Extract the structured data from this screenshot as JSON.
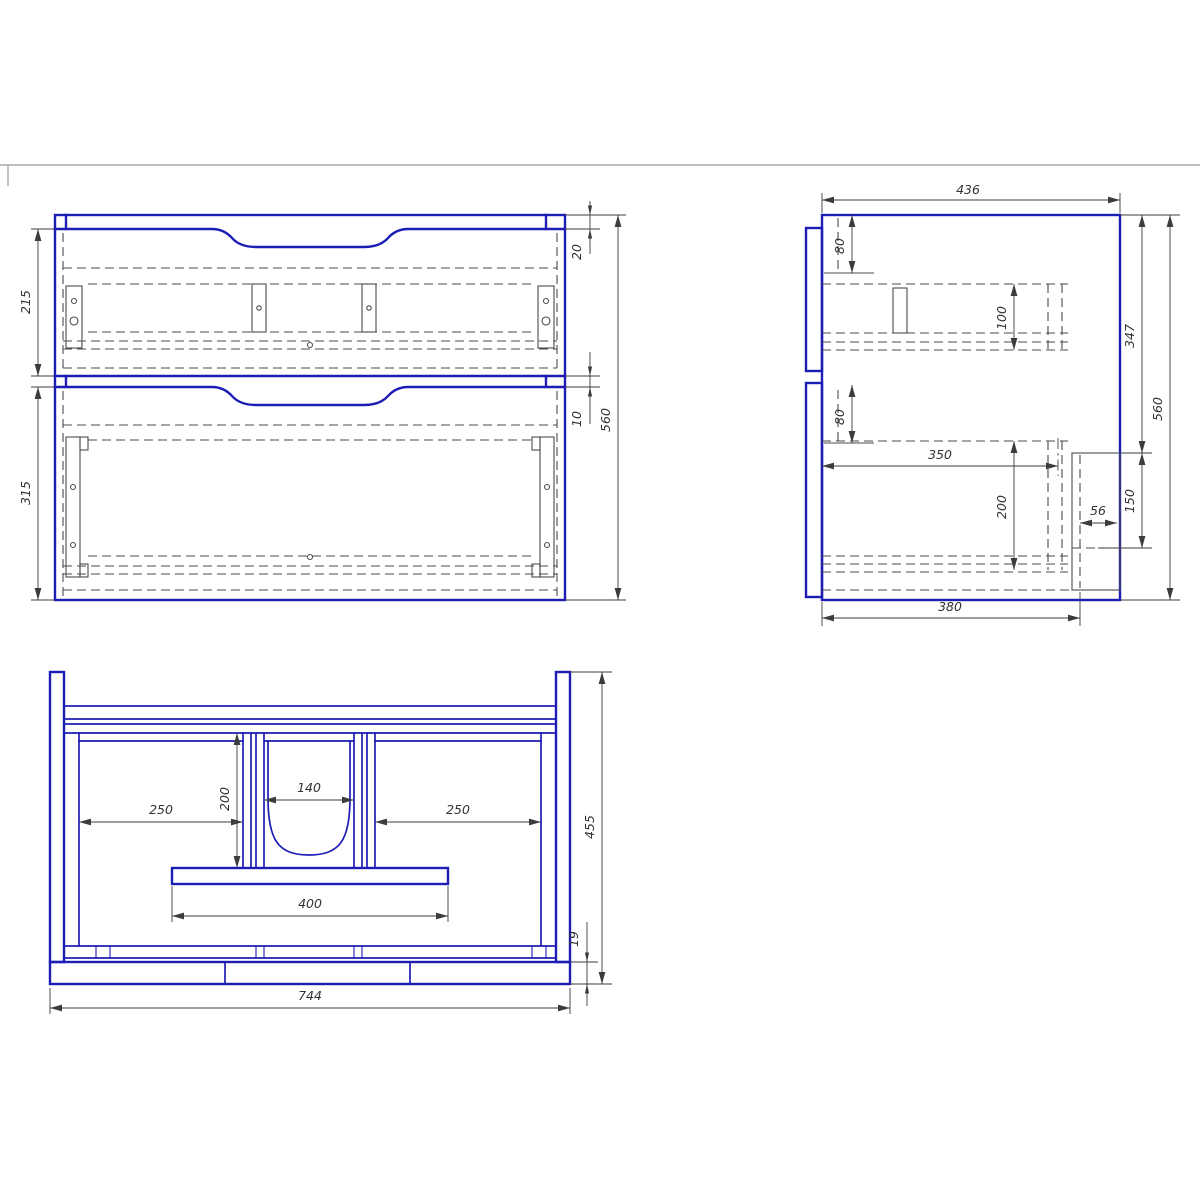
{
  "drawing": {
    "kind": "cabinet-technical-drawing",
    "colors": {
      "line_blue": "#1d1db5",
      "line_gray": "#4b4b4b",
      "frame_gray": "#9b9b9b",
      "text": "#333333"
    },
    "front_view": {
      "dims": {
        "top_panel_height": "20",
        "drawer1_height": "215",
        "gap": "10",
        "drawer2_height": "315",
        "total_height": "560"
      }
    },
    "side_view": {
      "dims": {
        "depth": "436",
        "upper_offset": "80",
        "rail_height": "100",
        "upper_section": "347",
        "total_height": "560",
        "lower_offset": "80",
        "runner_depth": "350",
        "lower_rail_height": "200",
        "bracket_inset": "56",
        "bracket_height": "150",
        "bottom_depth": "380"
      }
    },
    "bottom_view": {
      "dims": {
        "left_bay_width": "250",
        "center_depth": "200",
        "center_opening": "140",
        "right_bay_width": "250",
        "plate_width": "400",
        "total_width": "744",
        "total_depth": "455",
        "bottom_thickness": "19"
      }
    }
  }
}
